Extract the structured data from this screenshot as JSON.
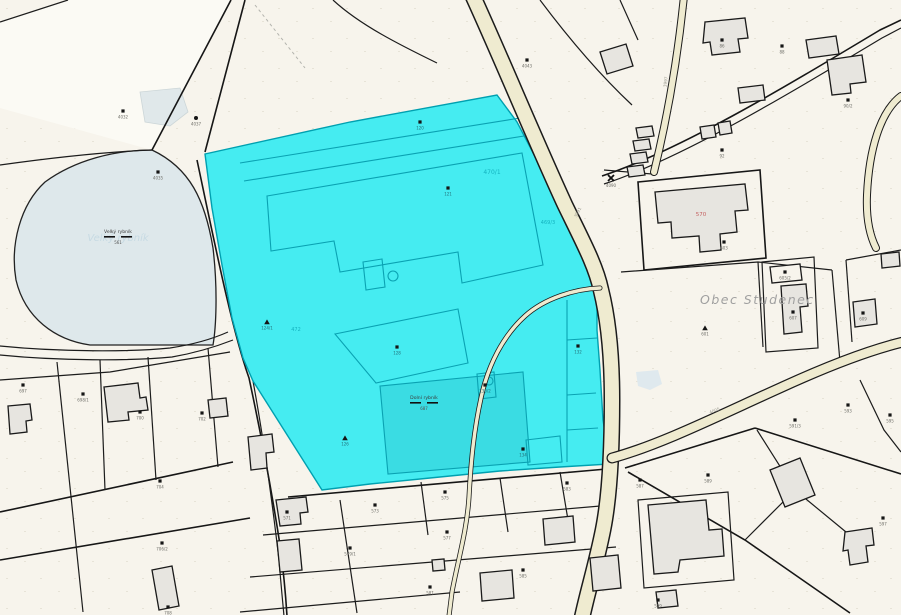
{
  "map": {
    "region_label": "Obec Studenec",
    "selected_color": "#45ecf1",
    "colors": {
      "background": "#f7f4ec",
      "road": "#efebd0",
      "water": "#dee8eb",
      "selected_fill": "#45ecf1",
      "selected_inner_lines": "#0aa2b2",
      "parcel_line": "#1c1c1c"
    },
    "pond": {
      "name": "Velký rybník",
      "number": "561",
      "watermark": "Velký rybník"
    },
    "cyan_pond": {
      "name": "Dolní rybník",
      "number": "687"
    },
    "red_parcel_number": "570",
    "cross_number": "4090",
    "road_labels": [
      {
        "t": "3991"
      },
      {
        "t": "4005"
      },
      {
        "t": "3997"
      }
    ],
    "cyan_labels": [
      {
        "t": "470/1"
      },
      {
        "t": "472"
      },
      {
        "t": "469/3"
      }
    ],
    "markers": [
      {
        "n": "4032"
      },
      {
        "n": "4035"
      },
      {
        "n": "4037"
      },
      {
        "n": "697"
      },
      {
        "n": "698/1"
      },
      {
        "n": "700"
      },
      {
        "n": "702"
      },
      {
        "n": "704"
      },
      {
        "n": "706/2"
      },
      {
        "n": "708"
      },
      {
        "n": "571"
      },
      {
        "n": "573"
      },
      {
        "n": "575"
      },
      {
        "n": "577"
      },
      {
        "n": "579/1"
      },
      {
        "n": "581"
      },
      {
        "n": "583"
      },
      {
        "n": "585"
      },
      {
        "n": "587"
      },
      {
        "n": "589"
      },
      {
        "n": "591/3"
      },
      {
        "n": "593"
      },
      {
        "n": "595"
      },
      {
        "n": "597"
      },
      {
        "n": "599"
      },
      {
        "n": "601"
      },
      {
        "n": "603"
      },
      {
        "n": "605/2"
      },
      {
        "n": "607"
      },
      {
        "n": "609"
      },
      {
        "n": "4043"
      },
      {
        "n": "86"
      },
      {
        "n": "88"
      },
      {
        "n": "90/2"
      },
      {
        "n": "92"
      }
    ],
    "cyan_markers": [
      {
        "n": "120"
      },
      {
        "n": "121"
      },
      {
        "n": "124/1"
      },
      {
        "n": "126"
      },
      {
        "n": "128"
      },
      {
        "n": "130/2"
      },
      {
        "n": "132"
      },
      {
        "n": "134"
      }
    ]
  }
}
